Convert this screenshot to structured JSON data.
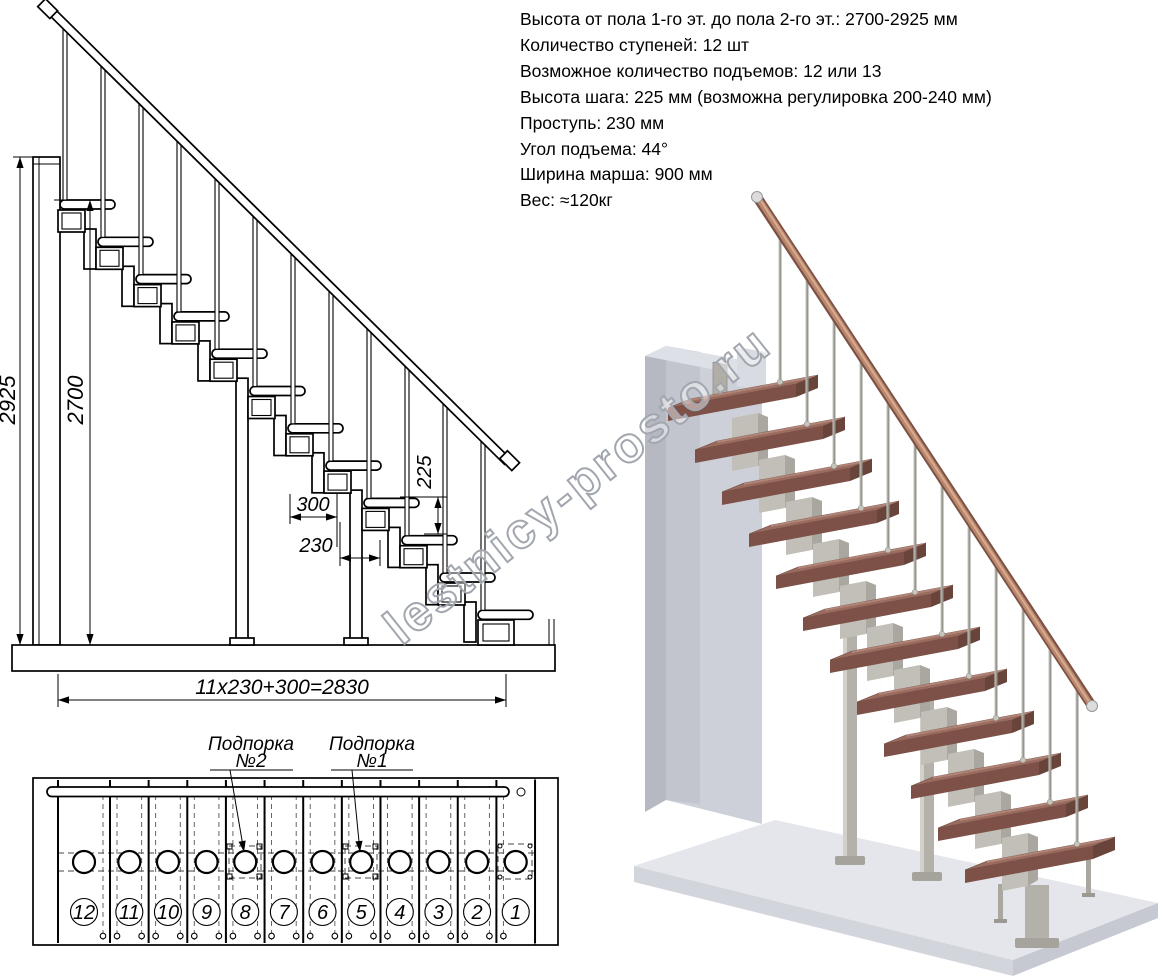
{
  "specs": {
    "lines": [
      "Высота от пола 1-го эт. до пола 2-го эт.: 2700-2925 мм",
      "Количество ступеней: 12 шт",
      "Возможное количество подъемов: 12 или 13",
      "Высота шага: 225 мм (возможна регулировка 200-240 мм)",
      "Проступь: 230 мм",
      "Угол подъема: 44°",
      "Ширина марша: 900 мм",
      "Вес: ≈120кг"
    ]
  },
  "elevation": {
    "dim_total_height": "2925",
    "dim_floor_to_floor": "2700",
    "dim_top_step_depth": "300",
    "dim_tread_depth": "230",
    "dim_step_rise": "225",
    "dim_total_run": "11x230+300=2830"
  },
  "plan": {
    "support_label_2_line1": "Подпорка",
    "support_label_2_line2": "№2",
    "support_label_1_line1": "Подпорка",
    "support_label_1_line2": "№1",
    "step_numbers": [
      "12",
      "11",
      "10",
      "9",
      "8",
      "7",
      "6",
      "5",
      "4",
      "3",
      "2",
      "1"
    ]
  },
  "watermark": "lestnicy-prosto.ru",
  "colors": {
    "tread_top": "#9a6b5f",
    "tread_front": "#7d5148",
    "handrail": "#b9886e",
    "metal": "#b3b1a9",
    "wall": "#cdd0d8",
    "floor": "#e4e6ec",
    "line": "#000000",
    "watermark_stroke": "#a2a7af"
  }
}
